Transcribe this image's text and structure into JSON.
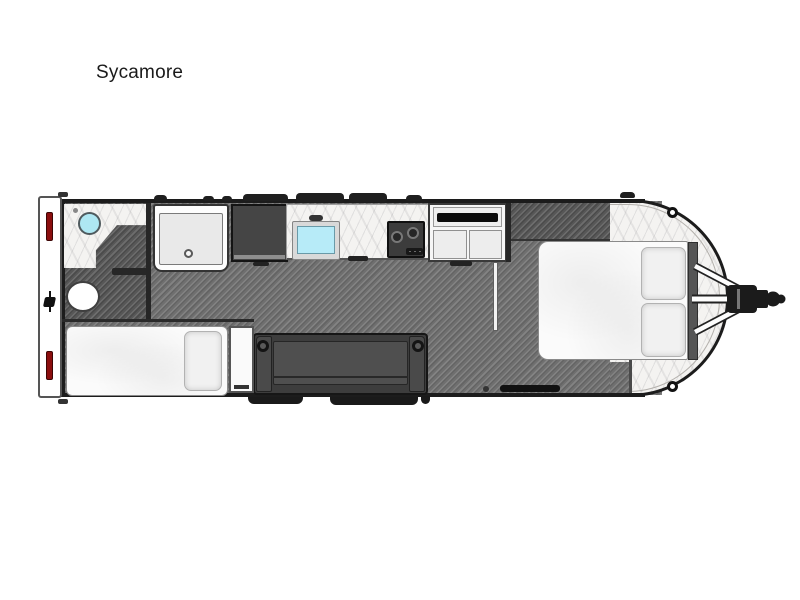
{
  "title": "Sycamore",
  "floorplan": {
    "model_name": "Sycamore",
    "type": "travel-trailer-top-view-floorplan",
    "orientation": "hitch-on-right",
    "colors": {
      "background": "#ffffff",
      "wall": "#1c1c1c",
      "floor_main": "#6f6f6f",
      "floor_dark": "#575757",
      "marble_floor": "#f4f3f1",
      "sink_water": "#aee7f2",
      "tail_light_red": "#8b0e0e",
      "sofa_gray": "#3d3d3d",
      "bedding_white": "#fbfbfb"
    },
    "features": [
      {
        "name": "bathroom-vanity-sink",
        "area": "rear-left"
      },
      {
        "name": "toilet",
        "area": "rear-left"
      },
      {
        "name": "shower",
        "area": "rear"
      },
      {
        "name": "refrigerator",
        "area": "kitchen"
      },
      {
        "name": "kitchen-sink",
        "area": "kitchen"
      },
      {
        "name": "cooktop-two-burner",
        "area": "kitchen"
      },
      {
        "name": "overhead-cabinet-with-tv",
        "area": "kitchen"
      },
      {
        "name": "privacy-partition",
        "area": "bedroom-entry"
      },
      {
        "name": "queen-bed-with-pillows",
        "area": "front-bedroom"
      },
      {
        "name": "headboard",
        "area": "front-bedroom"
      },
      {
        "name": "twin-bed",
        "area": "rear-left"
      },
      {
        "name": "nightstand",
        "area": "mid"
      },
      {
        "name": "sofa-with-cupholders",
        "area": "mid"
      },
      {
        "name": "entry-step",
        "area": "bottom-wall"
      },
      {
        "name": "a-frame-hitch-and-coupler",
        "area": "front"
      }
    ]
  }
}
